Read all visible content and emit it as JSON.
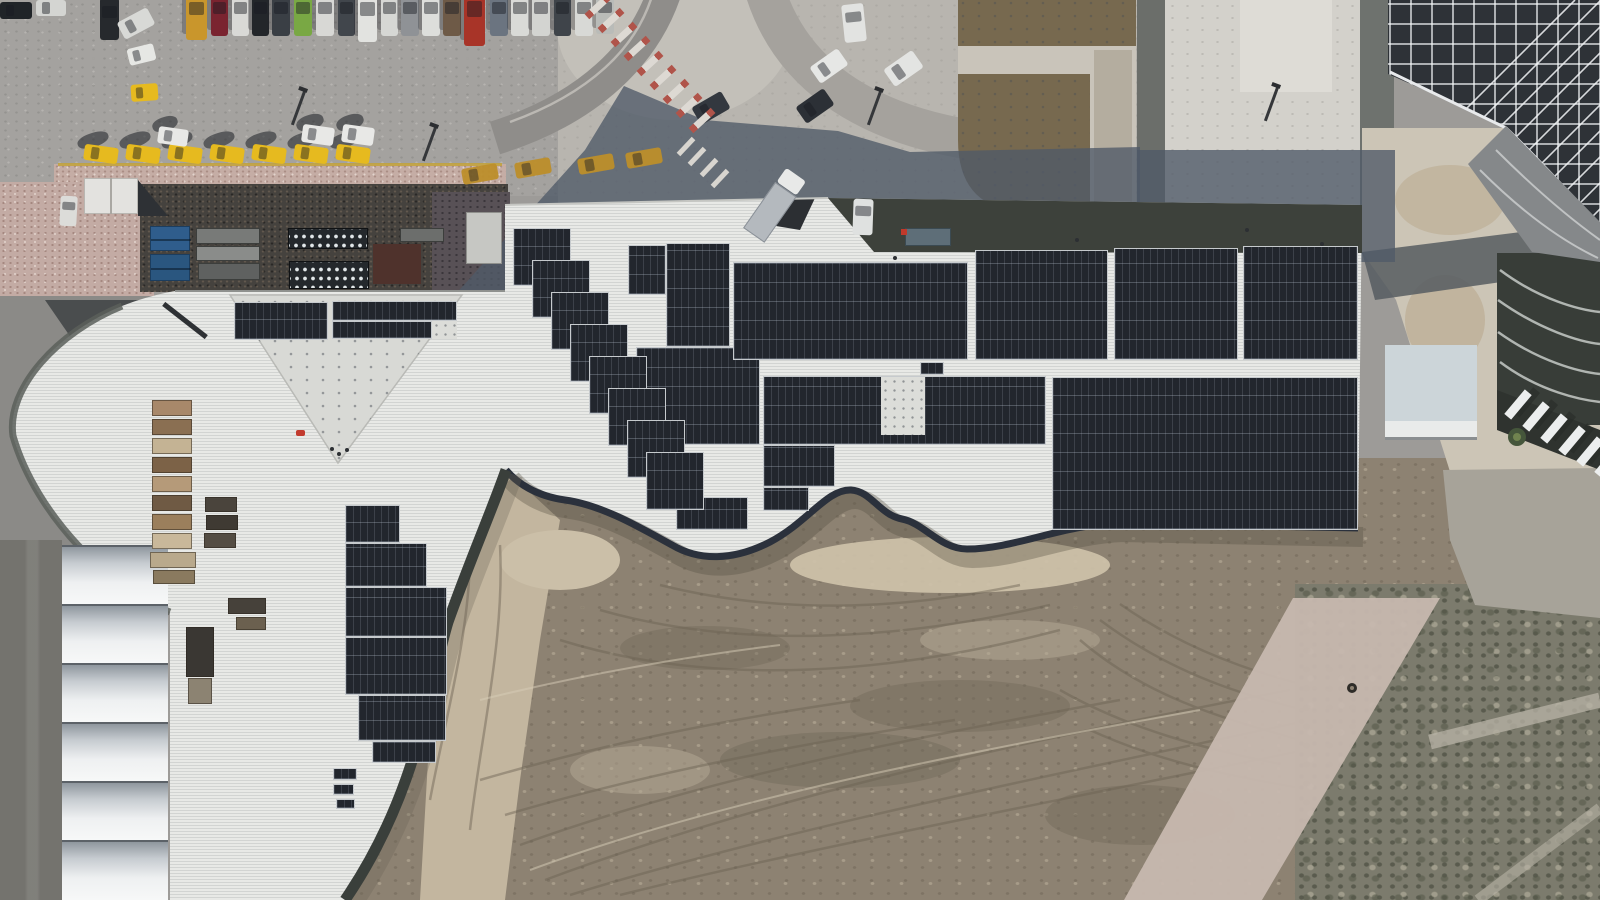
{
  "scene": {
    "type": "aerial-drone-photograph",
    "subject": "rooftop solar panel installation on large building with parking lot, taxi rank, tents and construction dirt field",
    "width": 1600,
    "height": 900
  },
  "colors": {
    "asphalt": "#a4a29f",
    "plaza": "#b8b5af",
    "island": "#c3c0b9",
    "roofWhite": "#e8e9e6",
    "roofTriangle": "#d8d9d5",
    "roofInset": "#3d413b",
    "panel": "#22262d",
    "fascia": "#2b313c",
    "dirt": "#8d8272",
    "dirtTan": "#c3b69f",
    "scrub": "#7c7b6d",
    "pathPink": "#c7b8af",
    "cobble": "#c5ada5",
    "yard": "#45423e",
    "taxi": "#e6ba1f",
    "taxiShaded": "#bd8f2b",
    "shadow": "#4f5a68",
    "containerBlue": "#305d8c",
    "white": "#e2e3e0",
    "latticeDark": "#2e3237"
  },
  "parking": {
    "top_row_cars": [
      {
        "x": 186,
        "y": -8,
        "w": 21,
        "h": 48,
        "c": "#c9962c"
      },
      {
        "x": 211,
        "y": -6,
        "w": 17,
        "h": 42,
        "c": "#7a2430"
      },
      {
        "x": 232,
        "y": -6,
        "w": 17,
        "h": 42,
        "c": "#d9d9d6"
      },
      {
        "x": 252,
        "y": -6,
        "w": 17,
        "h": 42,
        "c": "#23262a"
      },
      {
        "x": 272,
        "y": -6,
        "w": 18,
        "h": 42,
        "c": "#3a3f45"
      },
      {
        "x": 294,
        "y": -6,
        "w": 18,
        "h": 42,
        "c": "#79a844"
      },
      {
        "x": 316,
        "y": -6,
        "w": 18,
        "h": 42,
        "c": "#d8d8d5"
      },
      {
        "x": 338,
        "y": -6,
        "w": 17,
        "h": 42,
        "c": "#41464c"
      },
      {
        "x": 358,
        "y": -8,
        "w": 19,
        "h": 50,
        "c": "#e2e3e0"
      },
      {
        "x": 381,
        "y": -6,
        "w": 17,
        "h": 42,
        "c": "#d6d7d4"
      },
      {
        "x": 401,
        "y": -6,
        "w": 18,
        "h": 42,
        "c": "#8f9296"
      },
      {
        "x": 422,
        "y": -6,
        "w": 18,
        "h": 42,
        "c": "#dddedb"
      },
      {
        "x": 443,
        "y": -6,
        "w": 18,
        "h": 42,
        "c": "#6e5a47"
      },
      {
        "x": 464,
        "y": -10,
        "w": 21,
        "h": 56,
        "c": "#a83428"
      },
      {
        "x": 490,
        "y": -6,
        "w": 18,
        "h": 42,
        "c": "#6b7480"
      },
      {
        "x": 511,
        "y": -6,
        "w": 18,
        "h": 42,
        "c": "#d9dad7"
      },
      {
        "x": 532,
        "y": -6,
        "w": 18,
        "h": 42,
        "c": "#d3d4d1"
      },
      {
        "x": 554,
        "y": -6,
        "w": 17,
        "h": 42,
        "c": "#3f444a"
      },
      {
        "x": 575,
        "y": -6,
        "w": 18,
        "h": 42,
        "c": "#d8d9d6"
      },
      {
        "x": 596,
        "y": -6,
        "w": 18,
        "h": 40,
        "c": "#b9bbb8"
      }
    ],
    "corner_cars": [
      {
        "x": 0,
        "y": 2,
        "w": 32,
        "h": 17,
        "c": "#202428",
        "rot": 0,
        "h_car": true
      },
      {
        "x": 36,
        "y": 0,
        "w": 30,
        "h": 16,
        "c": "#d4d5d2",
        "rot": 0,
        "h_car": true
      },
      {
        "x": 100,
        "y": -2,
        "w": 19,
        "h": 42,
        "c": "#26292d",
        "rot": 0
      },
      {
        "x": 119,
        "y": 14,
        "w": 34,
        "h": 19,
        "c": "#d8d9d6",
        "rot": -28,
        "h_car": true
      }
    ],
    "loose_cars": [
      {
        "x": 128,
        "y": 46,
        "w": 27,
        "h": 17,
        "c": "#e6e7e4",
        "rot": -14,
        "h_car": true
      },
      {
        "x": 131,
        "y": 84,
        "w": 27,
        "h": 17,
        "c": "#e6ba1f",
        "rot": -4,
        "h_car": true
      }
    ],
    "taxi_row": {
      "y": 146,
      "rot": 8,
      "w": 34,
      "h": 16,
      "xs": [
        84,
        126,
        168,
        210,
        252,
        294,
        336
      ]
    },
    "white_cars_in_row": [
      {
        "x": 158,
        "y": 128,
        "w": 30,
        "h": 17
      },
      {
        "x": 302,
        "y": 126,
        "w": 32,
        "h": 18
      },
      {
        "x": 342,
        "y": 126,
        "w": 32,
        "h": 18
      }
    ],
    "shadow_taxis": [
      {
        "x": 462,
        "y": 166
      },
      {
        "x": 515,
        "y": 160
      },
      {
        "x": 578,
        "y": 156
      },
      {
        "x": 626,
        "y": 150
      }
    ],
    "island_cars": [
      {
        "x": 812,
        "y": 56,
        "w": 34,
        "h": 20,
        "c": "#e6e7e5",
        "rot": -35,
        "h_car": true
      },
      {
        "x": 886,
        "y": 58,
        "w": 35,
        "h": 21,
        "c": "#e3e4e2",
        "rot": -35,
        "h_car": true
      },
      {
        "x": 798,
        "y": 96,
        "w": 34,
        "h": 20,
        "c": "#2c3036",
        "rot": -35,
        "h_car": true
      },
      {
        "x": 694,
        "y": 98,
        "w": 34,
        "h": 20,
        "c": "#33383f",
        "rot": -30,
        "h_car": true
      }
    ],
    "truck": {
      "x": 762,
      "y": 168,
      "rot": 35
    },
    "minibus": {
      "x": 843,
      "y": 4,
      "w": 22,
      "h": 38,
      "rot": -6,
      "c": "#e2e3e1"
    },
    "van_near_kiosk": {
      "x": 60,
      "y": 196,
      "w": 17,
      "h": 30,
      "c": "#dcdcd9",
      "rot": 3
    },
    "lamp_posts": [
      [
        297,
        90
      ],
      [
        428,
        126
      ],
      [
        873,
        90
      ],
      [
        1270,
        86
      ]
    ]
  },
  "crosswalks": [
    {
      "x1": 598,
      "y1": 6,
      "x2": 702,
      "y2": 120,
      "bars": 9,
      "len": 30,
      "thick": 7,
      "red_ends": true
    },
    {
      "x1": 686,
      "y1": 146,
      "x2": 720,
      "y2": 178,
      "bars": 4,
      "len": 22,
      "thick": 5,
      "red_ends": false
    }
  ],
  "service_yard": {
    "blue_containers": [
      {
        "x": 150,
        "y": 226,
        "w": 40,
        "h": 25,
        "c": "#2f5d8c"
      },
      {
        "x": 150,
        "y": 254,
        "w": 40,
        "h": 27,
        "c": "#2a567f"
      }
    ],
    "gray_containers": [
      {
        "x": 196,
        "y": 228,
        "w": 64,
        "h": 16,
        "c": "#787a78"
      },
      {
        "x": 196,
        "y": 246,
        "w": 64,
        "h": 15,
        "c": "#8a8c8a"
      },
      {
        "x": 198,
        "y": 263,
        "w": 62,
        "h": 17,
        "c": "#5f6160"
      },
      {
        "x": 400,
        "y": 228,
        "w": 44,
        "h": 14,
        "c": "#6c6e6c"
      }
    ],
    "vents": [
      {
        "x": 288,
        "y": 228,
        "w": 80,
        "h": 21
      },
      {
        "x": 289,
        "y": 261,
        "w": 80,
        "h": 28
      }
    ],
    "maroon_box": {
      "x": 373,
      "y": 244,
      "w": 48,
      "h": 40,
      "c": "#4f322c"
    },
    "light_container": {
      "x": 466,
      "y": 212,
      "w": 36,
      "h": 52,
      "c": "#c6c7c3"
    }
  },
  "building": {
    "solar_arrays": [
      {
        "x": 234,
        "y": 302,
        "w": 94,
        "h": 38
      },
      {
        "x": 332,
        "y": 301,
        "w": 125,
        "h": 20
      },
      {
        "x": 332,
        "y": 321,
        "w": 100,
        "h": 18
      },
      {
        "x": 345,
        "y": 505,
        "w": 55,
        "h": 38
      },
      {
        "x": 345,
        "y": 543,
        "w": 82,
        "h": 44
      },
      {
        "x": 345,
        "y": 587,
        "w": 102,
        "h": 50
      },
      {
        "x": 345,
        "y": 637,
        "w": 102,
        "h": 58
      },
      {
        "x": 358,
        "y": 695,
        "w": 88,
        "h": 46
      },
      {
        "x": 372,
        "y": 741,
        "w": 64,
        "h": 22
      },
      {
        "x": 333,
        "y": 768,
        "w": 24,
        "h": 12
      },
      {
        "x": 333,
        "y": 784,
        "w": 21,
        "h": 11
      },
      {
        "x": 336,
        "y": 799,
        "w": 19,
        "h": 10
      },
      {
        "x": 628,
        "y": 245,
        "w": 38,
        "h": 50
      },
      {
        "x": 666,
        "y": 243,
        "w": 64,
        "h": 104
      },
      {
        "x": 636,
        "y": 347,
        "w": 124,
        "h": 98
      },
      {
        "x": 676,
        "y": 497,
        "w": 72,
        "h": 33
      },
      {
        "x": 733,
        "y": 262,
        "w": 235,
        "h": 98
      },
      {
        "x": 975,
        "y": 250,
        "w": 133,
        "h": 110
      },
      {
        "x": 1114,
        "y": 248,
        "w": 124,
        "h": 112
      },
      {
        "x": 1243,
        "y": 246,
        "w": 115,
        "h": 114
      },
      {
        "x": 763,
        "y": 376,
        "w": 283,
        "h": 69
      },
      {
        "x": 763,
        "y": 445,
        "w": 72,
        "h": 42
      },
      {
        "x": 763,
        "y": 487,
        "w": 46,
        "h": 24
      },
      {
        "x": 1052,
        "y": 377,
        "w": 306,
        "h": 153
      },
      {
        "x": 920,
        "y": 362,
        "w": 24,
        "h": 13
      }
    ],
    "staircase": {
      "x0": 513,
      "y0": 228,
      "dx": 19,
      "dy": 32,
      "w": 58,
      "h": 58,
      "count": 8
    },
    "panel_gaps": [
      {
        "x": 881,
        "y": 377,
        "w": 44,
        "h": 58
      },
      {
        "x": 432,
        "y": 321,
        "w": 25,
        "h": 18
      }
    ],
    "workers": [
      [
        337,
        452
      ],
      [
        345,
        448
      ],
      [
        330,
        447
      ],
      [
        893,
        256
      ],
      [
        1075,
        238
      ],
      [
        1245,
        228
      ],
      [
        1320,
        242
      ]
    ],
    "red_worker": {
      "x": 296,
      "y": 430,
      "w": 9,
      "h": 6,
      "c": "#c23b2e"
    },
    "inset_van": {
      "x": 853,
      "y": 199,
      "w": 20,
      "h": 36,
      "c": "#dfe1e0",
      "rot": 2
    },
    "inset_container": {
      "x": 905,
      "y": 228,
      "w": 46,
      "h": 18,
      "c": "#5e6e78"
    },
    "inset_flag": {
      "x": 901,
      "y": 229,
      "w": 6,
      "h": 6,
      "c": "#c0392b"
    },
    "pallets": [
      {
        "x": 152,
        "y": 400,
        "w": 40,
        "h": 16,
        "c": "#a8886a"
      },
      {
        "x": 152,
        "y": 419,
        "w": 40,
        "h": 16,
        "c": "#8a6f52"
      },
      {
        "x": 152,
        "y": 438,
        "w": 40,
        "h": 16,
        "c": "#c4b394"
      },
      {
        "x": 152,
        "y": 457,
        "w": 40,
        "h": 16,
        "c": "#7c6247"
      },
      {
        "x": 152,
        "y": 476,
        "w": 40,
        "h": 16,
        "c": "#b59a79"
      },
      {
        "x": 152,
        "y": 495,
        "w": 40,
        "h": 16,
        "c": "#6f5a44"
      },
      {
        "x": 152,
        "y": 514,
        "w": 40,
        "h": 16,
        "c": "#9b7f5c"
      },
      {
        "x": 152,
        "y": 533,
        "w": 40,
        "h": 16,
        "c": "#c9b89a"
      },
      {
        "x": 205,
        "y": 497,
        "w": 32,
        "h": 15,
        "c": "#4a443c"
      },
      {
        "x": 206,
        "y": 515,
        "w": 32,
        "h": 15,
        "c": "#3f3a33"
      },
      {
        "x": 204,
        "y": 533,
        "w": 32,
        "h": 15,
        "c": "#544d43"
      },
      {
        "x": 150,
        "y": 552,
        "w": 46,
        "h": 16,
        "c": "#b9a98c"
      },
      {
        "x": 153,
        "y": 570,
        "w": 42,
        "h": 14,
        "c": "#8a7a5f"
      },
      {
        "x": 228,
        "y": 598,
        "w": 38,
        "h": 16,
        "c": "#46413a"
      },
      {
        "x": 236,
        "y": 617,
        "w": 30,
        "h": 13,
        "c": "#6b604f"
      },
      {
        "x": 186,
        "y": 627,
        "w": 28,
        "h": 50,
        "c": "#3a3733"
      },
      {
        "x": 188,
        "y": 678,
        "w": 24,
        "h": 26,
        "c": "#8c8372"
      }
    ],
    "boom": {
      "x": 158,
      "y": 318,
      "w": 54,
      "h": 5,
      "rot": 38,
      "c": "#2e3134"
    }
  },
  "tents": {
    "x": 62,
    "w": 106,
    "top": 545,
    "segment_h": 59,
    "count": 6
  },
  "right_side": {
    "fins": [
      [
        1502,
        400
      ],
      [
        1520,
        412
      ],
      [
        1538,
        424
      ],
      [
        1556,
        436
      ],
      [
        1574,
        447
      ],
      [
        1592,
        458
      ]
    ],
    "tree": {
      "cx": 1517,
      "cy": 437,
      "r": 9
    }
  }
}
